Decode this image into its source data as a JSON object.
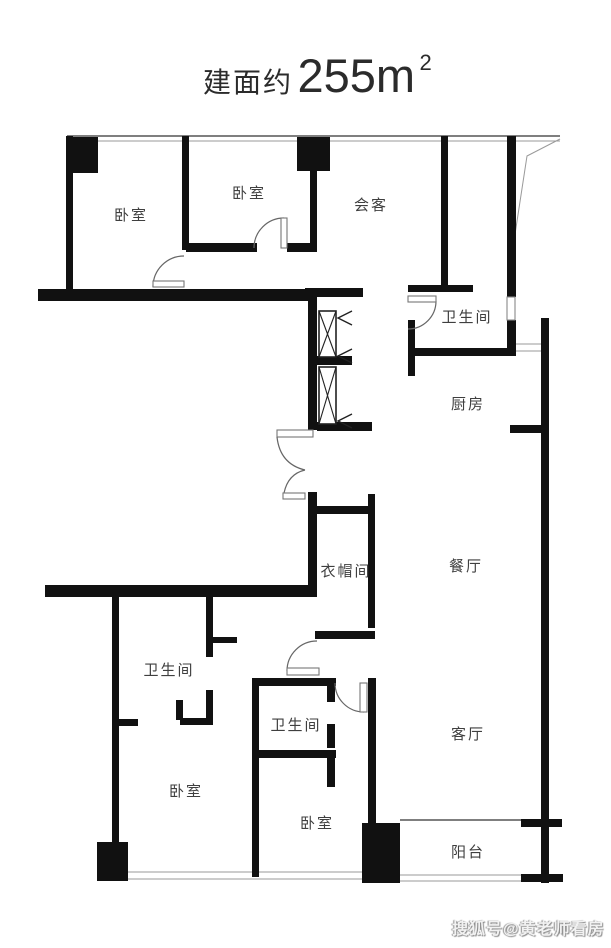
{
  "title": {
    "prefix": "建面约",
    "area_value": "255m",
    "area_superscript": "2"
  },
  "rooms": [
    {
      "id": "bedroom-top-left",
      "label": "卧室"
    },
    {
      "id": "bedroom-top-middle",
      "label": "卧室"
    },
    {
      "id": "reception",
      "label": "会客"
    },
    {
      "id": "bathroom-top",
      "label": "卫生间"
    },
    {
      "id": "kitchen",
      "label": "厨房"
    },
    {
      "id": "cloakroom",
      "label": "衣帽间"
    },
    {
      "id": "dining-room",
      "label": "餐厅"
    },
    {
      "id": "bathroom-left",
      "label": "卫生间"
    },
    {
      "id": "bathroom-middle",
      "label": "卫生间"
    },
    {
      "id": "bedroom-bottom-left",
      "label": "卧室"
    },
    {
      "id": "bedroom-bottom-middle",
      "label": "卧室"
    },
    {
      "id": "living-room",
      "label": "客厅"
    },
    {
      "id": "balcony",
      "label": "阳台"
    }
  ],
  "watermark": {
    "text": "搜狐号@黄老师看房"
  },
  "colors": {
    "wall": "#111111",
    "label": "#3f3f3f",
    "line": "#555555",
    "background": "#ffffff",
    "watermark": "#f2f2f2",
    "watermark_shadow": "#8a8a8a"
  }
}
